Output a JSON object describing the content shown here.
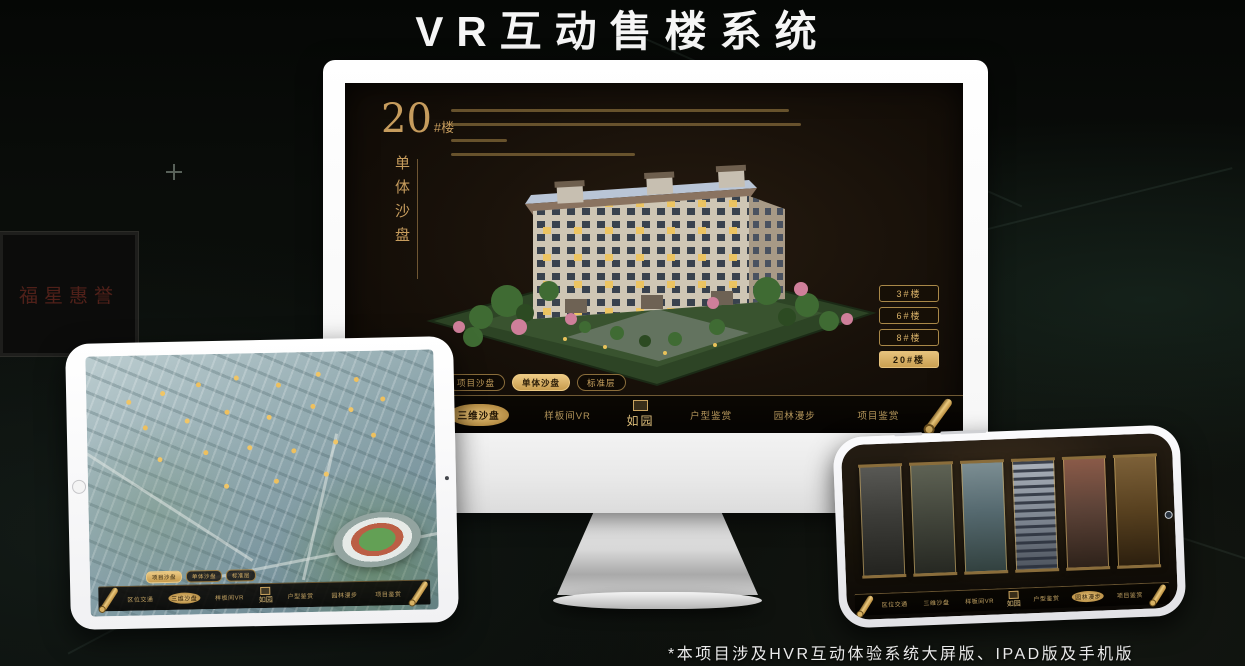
{
  "page": {
    "title": "VR互动售楼系统",
    "footnote": "*本项目涉及HVR互动体验系统大屏版、IPAD版及手机版"
  },
  "background": {
    "plaque_text": "福星惠誉"
  },
  "colors": {
    "gold": "#c9a35f",
    "gold_active": "#d9b269",
    "screen_bg": "#171009"
  },
  "nav": {
    "logo": "如园",
    "items": [
      "区位交通",
      "三维沙盘",
      "样板间VR",
      "户型鉴赏",
      "园林漫步",
      "项目鉴赏"
    ],
    "monitor_active": "三维沙盘",
    "tablet_active": "三维沙盘",
    "phone_active": "园林漫步"
  },
  "monitor": {
    "building_no": "20",
    "building_no_suffix": "#楼",
    "subtitle": "单体沙盘",
    "floor_buttons": [
      "3#楼",
      "6#楼",
      "8#楼",
      "20#楼"
    ],
    "view_tabs": [
      "项目沙盘",
      "单体沙盘",
      "标准层"
    ]
  }
}
